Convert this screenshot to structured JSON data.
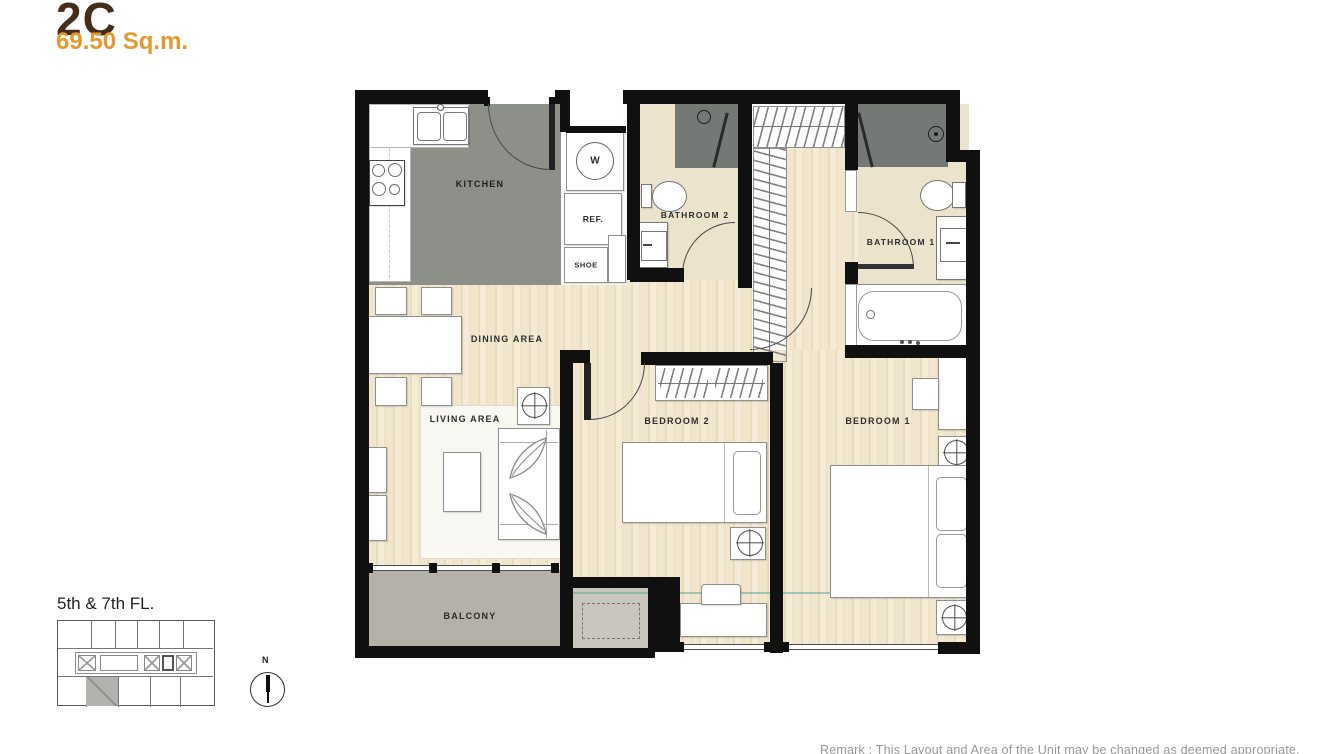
{
  "header": {
    "unit_code": "2C",
    "unit_area": "69.50 Sq.m."
  },
  "floor_plan": {
    "rooms": {
      "kitchen": "KITCHEN",
      "dining_area": "DINING AREA",
      "living_area": "LIVING AREA",
      "balcony": "BALCONY",
      "bedroom_1": "BEDROOM 1",
      "bedroom_2": "BEDROOM 2",
      "bathroom_1": "BATHROOM 1",
      "bathroom_2": "BATHROOM 2"
    },
    "fixtures": {
      "washer": "W",
      "refrigerator": "REF.",
      "shoe_cabinet": "SHOE"
    }
  },
  "key_plan": {
    "floor_label": "5th & 7th FL."
  },
  "compass": {
    "north_label": "N"
  },
  "footer": {
    "remark": "Remark :  This Layout and Area of the Unit may be changed as deemed appropriate."
  },
  "colors": {
    "accent_brown": "#462c1b",
    "accent_orange": "#e6982e",
    "wall": "#101010",
    "wood_floor": "#f0e5cb",
    "kitchen_floor": "#8c9089",
    "bathroom_floor": "#ebe3cc",
    "shower_floor": "#757975",
    "balcony_floor": "#b3b1a8",
    "ledge_floor": "#c9c7bd"
  }
}
